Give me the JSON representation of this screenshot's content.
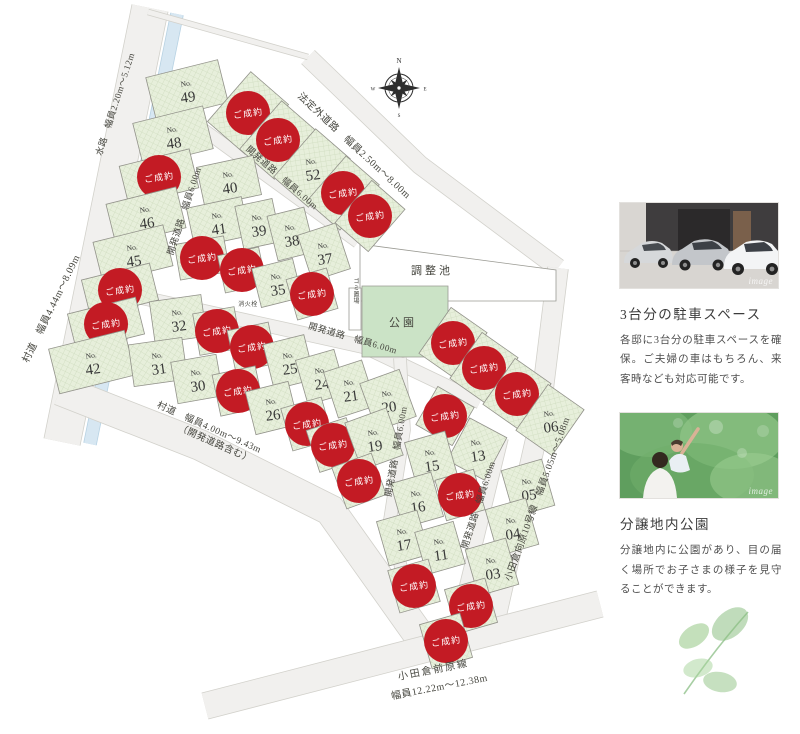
{
  "map": {
    "sold_label": "ご成約",
    "no_prefix": "No.",
    "colors": {
      "sold_red": "#c31b24",
      "lot_green": "#e7efdb",
      "lot_hatch": "#cedbbe",
      "park_green": "#cbe3c6",
      "water_blue": "#d7e7f2",
      "water_edge": "#b7d2e3",
      "road_gray": "#f1f0ee",
      "road_edge": "#d2d1cb",
      "line_gray": "#92928a",
      "label_ink": "#45453e",
      "badge_text": "#ffffff",
      "number_ink": "#383838"
    },
    "compass": {
      "x": 399,
      "y": 88,
      "n": "N",
      "e": "E",
      "s": "S",
      "w": "W"
    },
    "roads": [
      {
        "name": "road-sondo-left",
        "d": "M150,8 L62,442",
        "w": 36
      },
      {
        "name": "waterway",
        "d": "M177,14 L90,444",
        "w": 12,
        "water": true
      },
      {
        "name": "road-houteigai",
        "d": "M308,57 L420,165 L558,268",
        "w": 18
      },
      {
        "name": "road-kaihatsu-a",
        "d": "M207,72 L117,347",
        "w": 14
      },
      {
        "name": "road-kaihatsu-b",
        "d": "M190,120 L358,242",
        "w": 12
      },
      {
        "name": "road-kaihatsu-c",
        "d": "M103,289 L365,347 L480,402",
        "w": 13
      },
      {
        "name": "road-kaihatsu-v1",
        "d": "M400,358 L404,430 L390,520 L415,628",
        "w": 12
      },
      {
        "name": "road-kaihatsu-v2",
        "d": "M502,438 L458,618",
        "w": 12
      },
      {
        "name": "road-sondo-bottom",
        "d": "M60,390 L200,445 L330,510 L428,648",
        "w": 30
      },
      {
        "name": "road-odakura-mukaihara",
        "d": "M558,268 L538,430 L490,642",
        "w": 20
      },
      {
        "name": "road-odakura-maehara",
        "d": "M205,706 L600,604",
        "w": 26
      },
      {
        "name": "site-boundary-top",
        "d": "M148,12 L308,57",
        "w": 5
      }
    ],
    "areas": [
      {
        "name": "retention-pond",
        "pts": "360,244 556,270 556,301 360,301",
        "fill": "white"
      },
      {
        "name": "park-area",
        "pts": "362,286 448,286 448,357 362,357",
        "fill": "park"
      },
      {
        "name": "garbage-spot",
        "pts": "349,288 361,288 361,330 349,330",
        "fill": "white"
      }
    ],
    "labels": [
      {
        "t": "村道　幅員4.44m〜8.09m",
        "x": 54,
        "y": 310,
        "r": -64,
        "s": 10
      },
      {
        "t": "水路　幅員2.20m〜5.12m",
        "x": 118,
        "y": 105,
        "r": -72,
        "s": 9
      },
      {
        "t": "法定外道路　幅員2.50m〜8.00m",
        "x": 352,
        "y": 148,
        "r": 43,
        "s": 10
      },
      {
        "t": "開発道路　幅員6.00m",
        "x": 280,
        "y": 180,
        "r": 41,
        "s": 9
      },
      {
        "t": "開発道路　幅員6.00m",
        "x": 187,
        "y": 212,
        "r": -72,
        "s": 9
      },
      {
        "t": "開発道路　幅員6.00m",
        "x": 352,
        "y": 341,
        "r": 16,
        "s": 9
      },
      {
        "t": "開発道路　幅員6.00m",
        "x": 399,
        "y": 452,
        "r": -80,
        "s": 9
      },
      {
        "t": "開発道路　幅員6.00m",
        "x": 481,
        "y": 506,
        "r": -72,
        "s": 9
      },
      {
        "t": "小田倉向原10号線　幅員5.05m〜5.08m",
        "x": 540,
        "y": 500,
        "r": -70,
        "s": 9.5
      },
      {
        "t": "村道　幅員4.00m〜9.43m",
        "x": 208,
        "y": 430,
        "r": 24,
        "s": 9.5
      },
      {
        "t": "（開発道路含む）",
        "x": 214,
        "y": 446,
        "r": 24,
        "s": 9.5
      },
      {
        "t": "小田倉前原線",
        "x": 434,
        "y": 673,
        "r": -11,
        "s": 10,
        "ls": 2
      },
      {
        "t": "幅員12.22m〜12.38m",
        "x": 440,
        "y": 690,
        "r": -11,
        "s": 10
      },
      {
        "t": "調整池",
        "x": 432,
        "y": 274,
        "r": 0,
        "s": 11,
        "ls": 3
      },
      {
        "t": "公園",
        "x": 403,
        "y": 326,
        "r": 0,
        "s": 11,
        "ls": 3
      },
      {
        "t": "ゴミ置場",
        "x": 355,
        "y": 291,
        "r": 0,
        "s": 6,
        "v": true
      },
      {
        "t": "消火栓",
        "x": 248,
        "y": 306,
        "r": 0,
        "s": 6
      }
    ],
    "lots": [
      {
        "n": "49",
        "x": 187,
        "y": 90,
        "w": 74,
        "h": 44,
        "r": -14
      },
      {
        "n": "48",
        "x": 173,
        "y": 136,
        "w": 72,
        "h": 44,
        "r": -14
      },
      {
        "n": "",
        "x": 159,
        "y": 177,
        "w": 72,
        "h": 40,
        "r": -14,
        "sold": true
      },
      {
        "n": "46",
        "x": 146,
        "y": 216,
        "w": 72,
        "h": 42,
        "r": -14
      },
      {
        "n": "45",
        "x": 133,
        "y": 254,
        "w": 72,
        "h": 42,
        "r": -14
      },
      {
        "n": "",
        "x": 120,
        "y": 290,
        "w": 70,
        "h": 38,
        "r": -14,
        "sold": true
      },
      {
        "n": "",
        "x": 106,
        "y": 324,
        "w": 70,
        "h": 38,
        "r": -14,
        "sold": true
      },
      {
        "n": "42",
        "x": 92,
        "y": 362,
        "w": 78,
        "h": 46,
        "r": -14
      },
      {
        "n": "",
        "x": 248,
        "y": 113,
        "w": 50,
        "h": 66,
        "r": 41,
        "sold": true
      },
      {
        "n": "",
        "x": 278,
        "y": 140,
        "w": 46,
        "h": 64,
        "r": 41,
        "sold": true
      },
      {
        "n": "52",
        "x": 312,
        "y": 168,
        "w": 46,
        "h": 64,
        "r": 41
      },
      {
        "n": "",
        "x": 343,
        "y": 193,
        "w": 44,
        "h": 60,
        "r": 41,
        "sold": true
      },
      {
        "n": "",
        "x": 370,
        "y": 216,
        "w": 44,
        "h": 56,
        "r": 41,
        "sold": true
      },
      {
        "n": "40",
        "x": 229,
        "y": 181,
        "w": 58,
        "h": 40,
        "r": -12
      },
      {
        "n": "41",
        "x": 218,
        "y": 222,
        "w": 56,
        "h": 40,
        "r": -12
      },
      {
        "n": "39",
        "x": 258,
        "y": 224,
        "w": 38,
        "h": 44,
        "r": -12
      },
      {
        "n": "38",
        "x": 291,
        "y": 234,
        "w": 38,
        "h": 46,
        "r": -14
      },
      {
        "n": "37",
        "x": 324,
        "y": 252,
        "w": 40,
        "h": 48,
        "r": -18
      },
      {
        "n": "",
        "x": 202,
        "y": 258,
        "w": 50,
        "h": 36,
        "r": -10,
        "sold": true
      },
      {
        "n": "",
        "x": 242,
        "y": 270,
        "w": 42,
        "h": 38,
        "r": -12,
        "sold": true
      },
      {
        "n": "35",
        "x": 277,
        "y": 283,
        "w": 42,
        "h": 40,
        "r": -14
      },
      {
        "n": "",
        "x": 312,
        "y": 294,
        "w": 42,
        "h": 42,
        "r": -16,
        "sold": true
      },
      {
        "n": "32",
        "x": 178,
        "y": 319,
        "w": 52,
        "h": 42,
        "r": -8
      },
      {
        "n": "",
        "x": 217,
        "y": 331,
        "w": 42,
        "h": 42,
        "r": -10,
        "sold": true
      },
      {
        "n": "",
        "x": 252,
        "y": 347,
        "w": 42,
        "h": 42,
        "r": -12,
        "sold": true
      },
      {
        "n": "25",
        "x": 289,
        "y": 362,
        "w": 42,
        "h": 46,
        "r": -14
      },
      {
        "n": "24",
        "x": 321,
        "y": 377,
        "w": 40,
        "h": 46,
        "r": -16
      },
      {
        "n": "21",
        "x": 350,
        "y": 389,
        "w": 40,
        "h": 48,
        "r": -18
      },
      {
        "n": "20",
        "x": 388,
        "y": 400,
        "w": 42,
        "h": 50,
        "r": -20
      },
      {
        "n": "31",
        "x": 158,
        "y": 362,
        "w": 54,
        "h": 42,
        "r": -8
      },
      {
        "n": "30",
        "x": 197,
        "y": 379,
        "w": 46,
        "h": 42,
        "r": -10
      },
      {
        "n": "",
        "x": 238,
        "y": 391,
        "w": 44,
        "h": 42,
        "r": -12,
        "sold": true
      },
      {
        "n": "26",
        "x": 272,
        "y": 408,
        "w": 44,
        "h": 44,
        "r": -14
      },
      {
        "n": "",
        "x": 307,
        "y": 424,
        "w": 42,
        "h": 44,
        "r": -16,
        "sold": true
      },
      {
        "n": "",
        "x": 333,
        "y": 445,
        "w": 42,
        "h": 44,
        "r": -18,
        "sold": true
      },
      {
        "n": "19",
        "x": 374,
        "y": 439,
        "w": 44,
        "h": 50,
        "r": -20
      },
      {
        "n": "",
        "x": 359,
        "y": 481,
        "w": 42,
        "h": 44,
        "r": -20,
        "sold": true
      },
      {
        "n": "",
        "x": 453,
        "y": 343,
        "w": 44,
        "h": 56,
        "r": 35,
        "sold": true
      },
      {
        "n": "",
        "x": 484,
        "y": 368,
        "w": 44,
        "h": 56,
        "r": 35,
        "sold": true
      },
      {
        "n": "",
        "x": 517,
        "y": 394,
        "w": 44,
        "h": 56,
        "r": 35,
        "sold": true
      },
      {
        "n": "06",
        "x": 550,
        "y": 420,
        "w": 44,
        "h": 56,
        "r": 35
      },
      {
        "n": "",
        "x": 445,
        "y": 416,
        "w": 42,
        "h": 44,
        "r": 30,
        "sold": true
      },
      {
        "n": "13",
        "x": 477,
        "y": 449,
        "w": 42,
        "h": 48,
        "r": 28
      },
      {
        "n": "15",
        "x": 431,
        "y": 459,
        "w": 42,
        "h": 46,
        "r": -16
      },
      {
        "n": "16",
        "x": 417,
        "y": 500,
        "w": 42,
        "h": 46,
        "r": -16
      },
      {
        "n": "17",
        "x": 403,
        "y": 538,
        "w": 42,
        "h": 46,
        "r": -16
      },
      {
        "n": "",
        "x": 460,
        "y": 495,
        "w": 40,
        "h": 42,
        "r": -16,
        "sold": true
      },
      {
        "n": "11",
        "x": 440,
        "y": 548,
        "w": 40,
        "h": 44,
        "r": -16
      },
      {
        "n": "",
        "x": 414,
        "y": 586,
        "w": 42,
        "h": 44,
        "r": -16,
        "sold": true
      },
      {
        "n": "05",
        "x": 528,
        "y": 488,
        "w": 42,
        "h": 48,
        "r": -16
      },
      {
        "n": "04",
        "x": 512,
        "y": 527,
        "w": 42,
        "h": 48,
        "r": -16
      },
      {
        "n": "03",
        "x": 492,
        "y": 567,
        "w": 42,
        "h": 48,
        "r": -16
      },
      {
        "n": "",
        "x": 471,
        "y": 606,
        "w": 42,
        "h": 46,
        "r": -16,
        "sold": true
      },
      {
        "n": "",
        "x": 446,
        "y": 641,
        "w": 42,
        "h": 46,
        "r": -16,
        "sold": true
      }
    ]
  },
  "sidebar": {
    "parking": {
      "title": "3台分の駐車スペース",
      "body": "各邸に3台分の駐車スペースを確保。ご夫婦の車はもちろん、来客時なども対応可能です。",
      "watermark": "image"
    },
    "park": {
      "title": "分譲地内公園",
      "body": "分譲地内に公園があり、目の届く場所でお子さまの様子を見守ることができます。",
      "watermark": "image"
    }
  }
}
